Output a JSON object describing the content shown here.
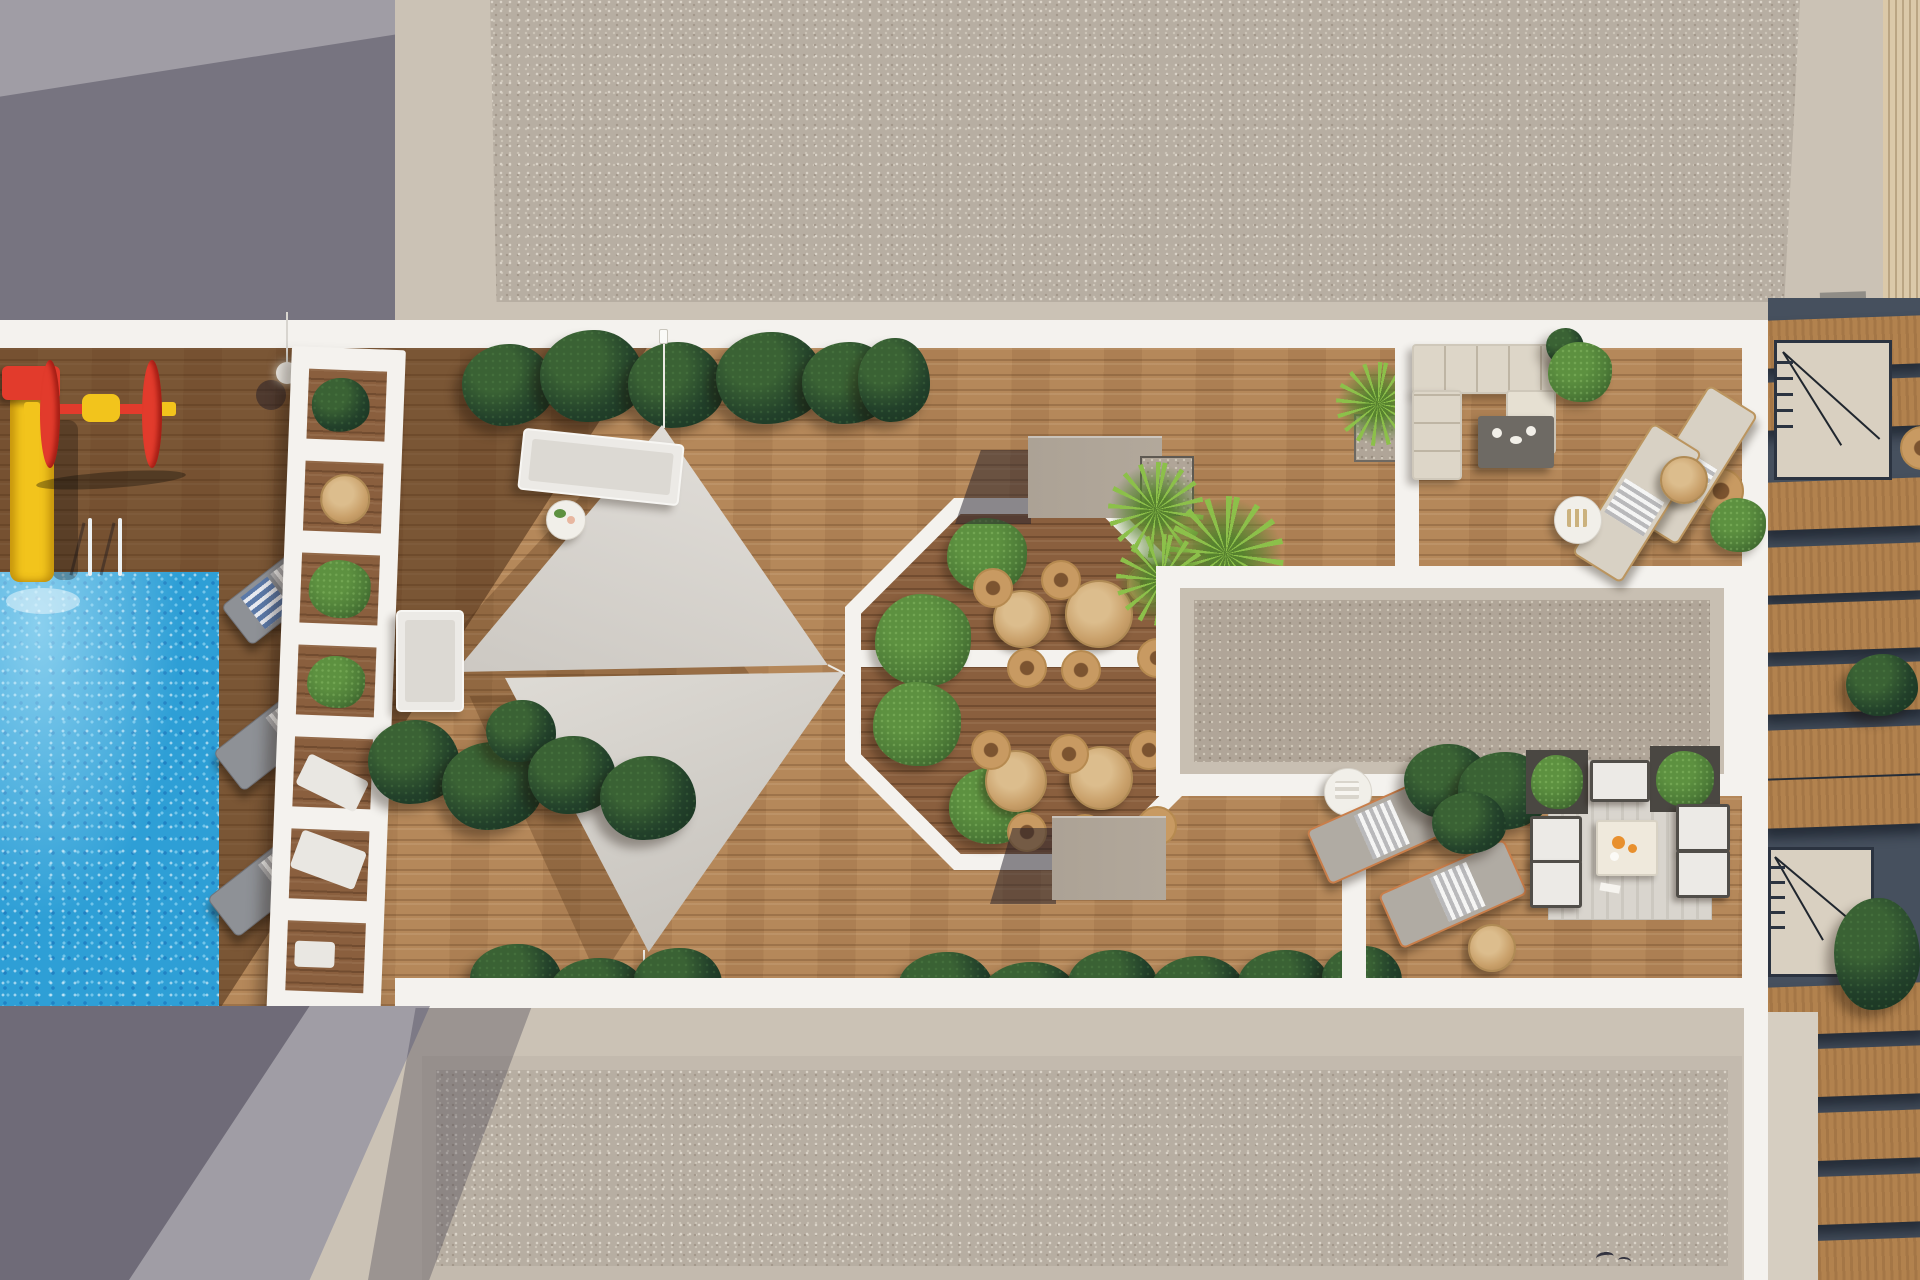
{
  "scene": {
    "title": "Rooftop amenity terrace — aerial architectural render",
    "view": "top-down drone view, afternoon sun casting long diagonal shadows",
    "areas": {
      "top_left": "smooth concrete roof slab in shadow",
      "top_band": "beige-bordered gravel roof field",
      "main_deck": "timber amenity deck with pool, playground, shade sails, octagonal dining court",
      "right_deck": "timber lounge deck with sofa set, chaise loungers and outdoor living set",
      "gravel_court": "white-framed gravel skylight court",
      "far_right": "private terraces with pergola planks and stair landings",
      "bottom_band": "beige-bordered gravel roof field with cast shadow"
    }
  },
  "objects": {
    "pool": "swimming pool with sparkling water",
    "pool-ladder": "chrome pool ladder",
    "water-slide": "yellow water slide with red cap",
    "spinner-toy": "red and yellow playground roller",
    "lamp-post": "deck lamp post",
    "pergola-trellis": "white slatted pergola with planting",
    "loungers-left": "grey cushioned sun loungers",
    "shade-sail-upper": "triangular shade sail",
    "shade-sail-lower": "triangular shade sail",
    "white-loungers": "white sun loungers",
    "drink-table": "round side table with drinks",
    "octagon-court": "white-framed octagonal dining court with rattan chairs, round tables and shrubs",
    "storage-cube": "taupe service cube",
    "palm-cluster": "bright green palms in planter",
    "yucca-plant": "yucca in square planter",
    "gravel-court": "gravel skylight court",
    "sofa-set": "L-shaped beige outdoor sofa with dark coffee table",
    "loungers-right": "beige chaise loungers with towels",
    "loungers-bottom": "grey chaise loungers with copper frames",
    "lounge-set": "outdoor lounge set on striped rug with fruit table",
    "stairs": "stair landing with railing",
    "plants-dark": "dark tropical foliage",
    "bird": "bird flying over the roof"
  },
  "colors": {
    "concrete": "#a09da5",
    "beige": "#cbc2b5",
    "white_walkway": "#f4f2ee",
    "gravel": "#b7aea2",
    "gravel_dot_light": "#dad3c8",
    "gravel_dot_dark": "#a2978a",
    "gravel_inner": "#b0a598",
    "wood_lit": "#b5885a",
    "octagon_floor": "#8a5f3e",
    "pool_blue": "#2e9fd6",
    "sail": "#d9d5cf",
    "plant_dark": "#22402a",
    "plant_bright": "#8cc04a",
    "bush": "#4e7d38",
    "slide_yellow": "#f2c41c",
    "toy_red": "#e23b2c",
    "cube_taupe": "#b2a89b",
    "lounger_gray": "#8e9196",
    "lounger_beige": "#d8d1c4",
    "lounger_white": "#eceae6",
    "rattan": "#c89a62",
    "table_wood": "#c9a06a",
    "sofa_beige": "#ddd6c8",
    "coffee_table": "#6e6a64",
    "rug": "#d9d5ce",
    "frame_dark": "#514e49",
    "copper": "#c97e4a",
    "terrace_navy": "#46505e",
    "plank_wood": "#b2824e",
    "platform_beige": "#d9d0c1",
    "fruit_orange": "#e8902e"
  }
}
